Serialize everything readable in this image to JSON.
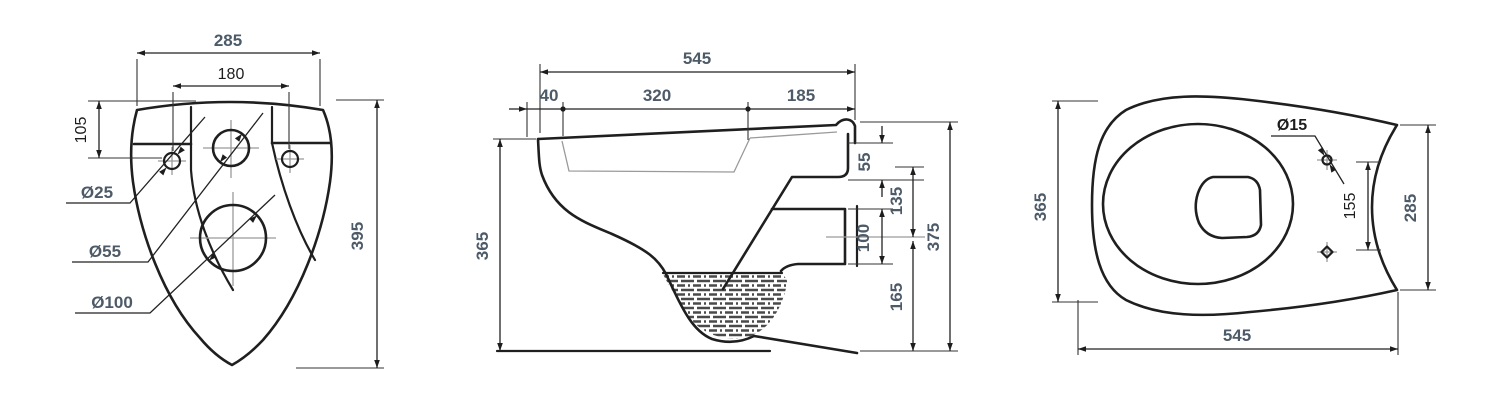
{
  "colors": {
    "background": "#ffffff",
    "line": "#1f1f1f",
    "label_slate": "#4d5a68",
    "label_black": "#1d1d1d",
    "centerline_gray": "#9a9a9a"
  },
  "views": {
    "rear": {
      "name": "rear view",
      "labels": {
        "w285": "285",
        "s180": "180",
        "h105": "105",
        "h395": "395",
        "d25": "Ø25",
        "d55": "Ø55",
        "d100": "Ø100"
      }
    },
    "side": {
      "name": "side section view",
      "labels": {
        "d545": "545",
        "s40": "40",
        "s320": "320",
        "s185": "185",
        "h365": "365",
        "h55": "55",
        "h100": "100",
        "h135": "135",
        "h165": "165",
        "h375": "375"
      }
    },
    "top": {
      "name": "top view",
      "labels": {
        "w365": "365",
        "d15": "Ø15",
        "s155": "155",
        "w285": "285",
        "d545": "545"
      }
    }
  }
}
